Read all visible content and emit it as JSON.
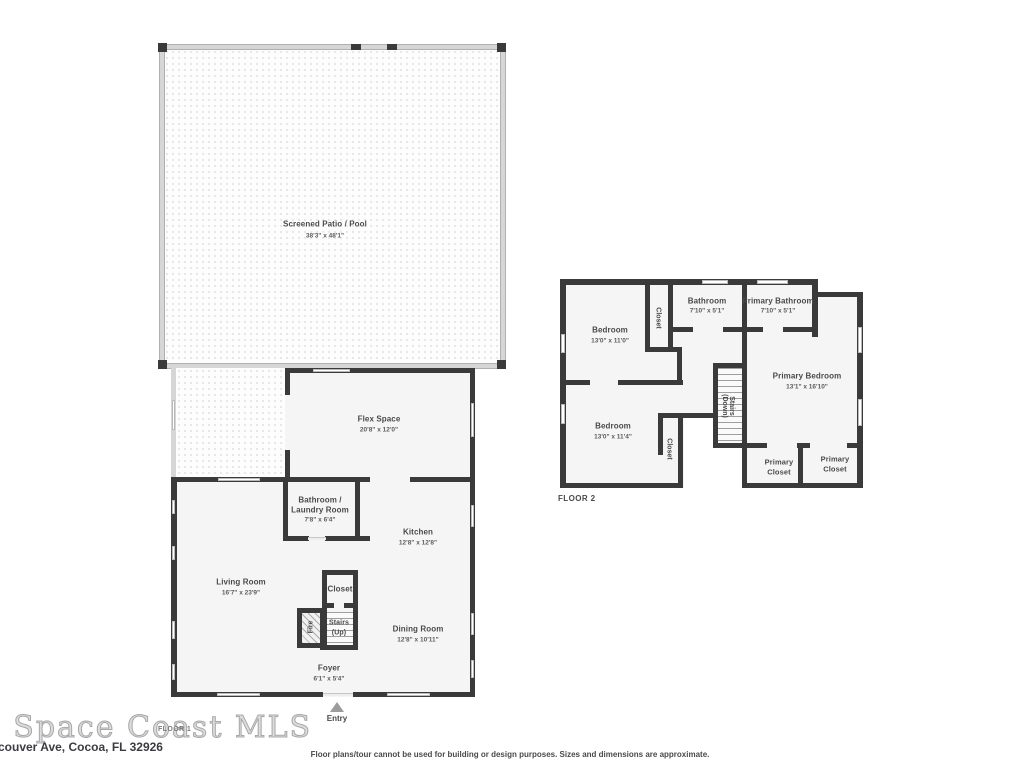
{
  "watermark": "e Space Coast MLS",
  "address": "couver Ave, Cocoa, FL 32926",
  "disclaimer": "Floor plans/tour cannot be used for building or design purposes. Sizes and dimensions are approximate.",
  "colors": {
    "wall": "#3a3a3a",
    "room_fill": "#f5f5f5",
    "label_text": "#4a4a4a",
    "watermark": "#c0c0c0",
    "entry_arrow": "#9c9c9c"
  },
  "floor1": {
    "label": "FLOOR 1",
    "entry_label": "Entry",
    "rooms": {
      "patio": {
        "name": "Screened Patio / Pool",
        "dims": "38'3\" x 48'1\""
      },
      "flex": {
        "name": "Flex Space",
        "dims": "20'8\" x 12'0\""
      },
      "bath_laundry": {
        "name1": "Bathroom /",
        "name2": "Laundry Room",
        "dims": "7'8\" x 6'4\""
      },
      "kitchen": {
        "name": "Kitchen",
        "dims": "12'8\" x 12'8\""
      },
      "living": {
        "name": "Living Room",
        "dims": "16'7\" x 23'9\""
      },
      "closet": {
        "name": "Closet"
      },
      "fireplace": {
        "name": "Fire"
      },
      "stairs": {
        "name1": "Stairs",
        "name2": "(Up)"
      },
      "dining": {
        "name": "Dining Room",
        "dims": "12'8\" x 10'11\""
      },
      "foyer": {
        "name": "Foyer",
        "dims": "6'1\" x 5'4\""
      }
    }
  },
  "floor2": {
    "label": "FLOOR 2",
    "rooms": {
      "bedroom1": {
        "name": "Bedroom",
        "dims": "13'0\" x 11'0\""
      },
      "closet_top": {
        "name": "Closet"
      },
      "bathroom": {
        "name": "Bathroom",
        "dims": "7'10\" x 5'1\""
      },
      "primary_bathroom": {
        "name": "Primary Bathroom",
        "dims": "7'10\" x 5'1\""
      },
      "primary_bedroom": {
        "name": "Primary Bedroom",
        "dims": "13'1\" x 16'10\""
      },
      "stairs": {
        "name1": "Stairs",
        "name2": "(Down)"
      },
      "bedroom2": {
        "name": "Bedroom",
        "dims": "13'0\" x 11'4\""
      },
      "closet_bottom": {
        "name": "Closet"
      },
      "primary_closet_left": {
        "name1": "Primary",
        "name2": "Closet"
      },
      "primary_closet_right": {
        "name1": "Primary",
        "name2": "Closet"
      }
    }
  }
}
